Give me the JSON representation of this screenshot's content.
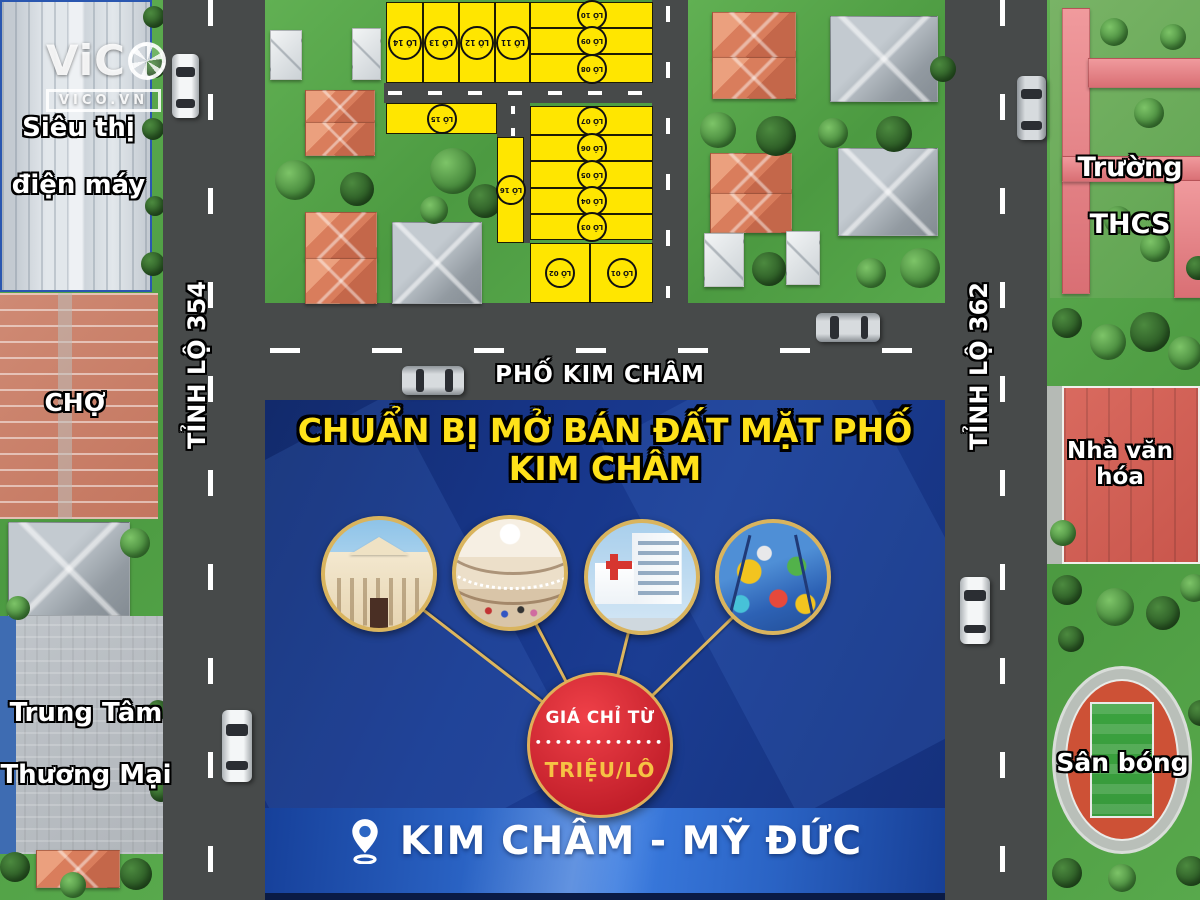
{
  "watermark": {
    "brand": "ViC",
    "brand_full": "ViCO",
    "aperture_icon": "camera-aperture-icon",
    "domain": "VICO.VN"
  },
  "roads": {
    "left_vertical": "TỈNH LỘ 354",
    "right_vertical": "TỈNH LỘ 362",
    "horizontal": "PHỐ KIM CHÂM"
  },
  "landmarks": {
    "supermarket": {
      "line1": "Siêu thị",
      "line2": "điện máy"
    },
    "market": "CHỢ",
    "trade_center": {
      "line1": "Trung Tâm",
      "line2": "Thương Mại"
    },
    "school": {
      "line1": "Trường",
      "line2": "THCS"
    },
    "culture_house": "Nhà văn hóa",
    "stadium": "Sân bóng"
  },
  "plots": [
    {
      "label": "LÔ 01"
    },
    {
      "label": "LÔ 02"
    },
    {
      "label": "LÔ 03"
    },
    {
      "label": "LÔ 04"
    },
    {
      "label": "LÔ 05"
    },
    {
      "label": "LÔ 06"
    },
    {
      "label": "LÔ 07"
    },
    {
      "label": "LÔ 08"
    },
    {
      "label": "LÔ 09"
    },
    {
      "label": "LÔ 10"
    },
    {
      "label": "LÔ 11"
    },
    {
      "label": "LÔ 12"
    },
    {
      "label": "LÔ 13"
    },
    {
      "label": "LÔ 14"
    },
    {
      "label": "LÔ 15"
    },
    {
      "label": "LÔ 16"
    }
  ],
  "panel": {
    "title_line1": "CHUẨN BỊ MỞ BÁN ĐẤT",
    "title_line2": "MẶT PHỐ KIM CHÂM",
    "amenity_photos": [
      "government-building",
      "shopping-mall-interior",
      "hospital",
      "indoor-playground"
    ],
    "price": {
      "prefix": "GIÁ CHỈ TỪ",
      "dots": "•••••••••••••",
      "unit": "TRIỆU/LÔ"
    },
    "location_pin_icon": "location-pin-icon",
    "location": "KIM CHÂM - MỸ ĐỨC"
  },
  "vehicles": {
    "car_count": 6
  },
  "colors": {
    "plot_yellow": "#FFE600",
    "road_gray": "#474A4A",
    "panel_navy": "#17368A",
    "gold": "#DDB65E",
    "price_red": "#C8232E",
    "title_yellow": "#FFE21A"
  }
}
